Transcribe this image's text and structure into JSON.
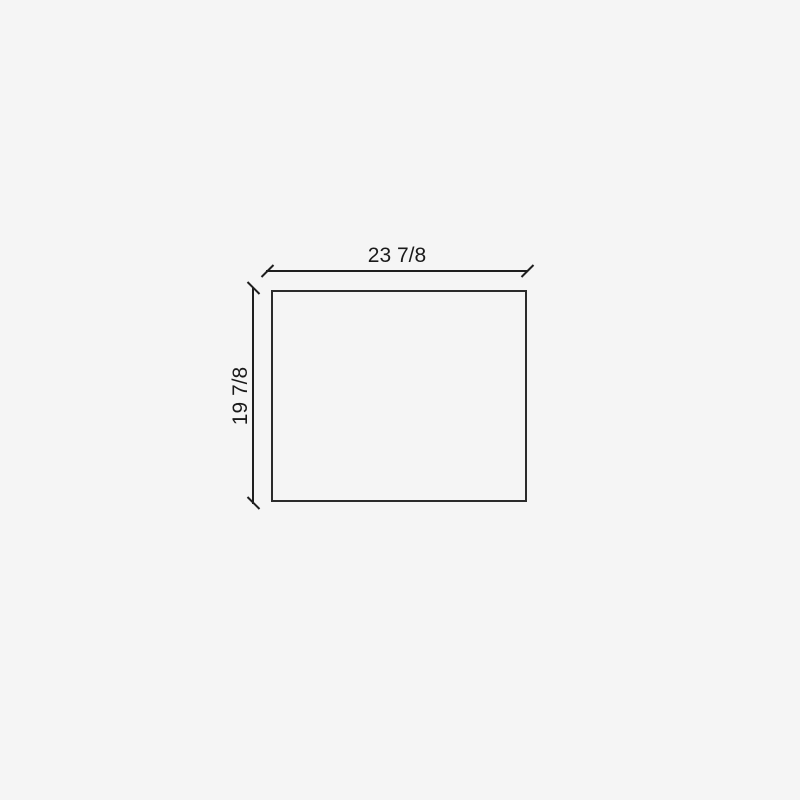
{
  "diagram": {
    "type": "dimensioned-rectangle-drawing",
    "shape": "rectangle",
    "width_dimension_label": "23 7/8",
    "height_dimension_label": "19 7/8",
    "colors": {
      "background": "#f5f5f5",
      "outline": "#2b2b2b",
      "dimension_line": "#1f1f1f",
      "text": "#1a1a1a"
    }
  }
}
